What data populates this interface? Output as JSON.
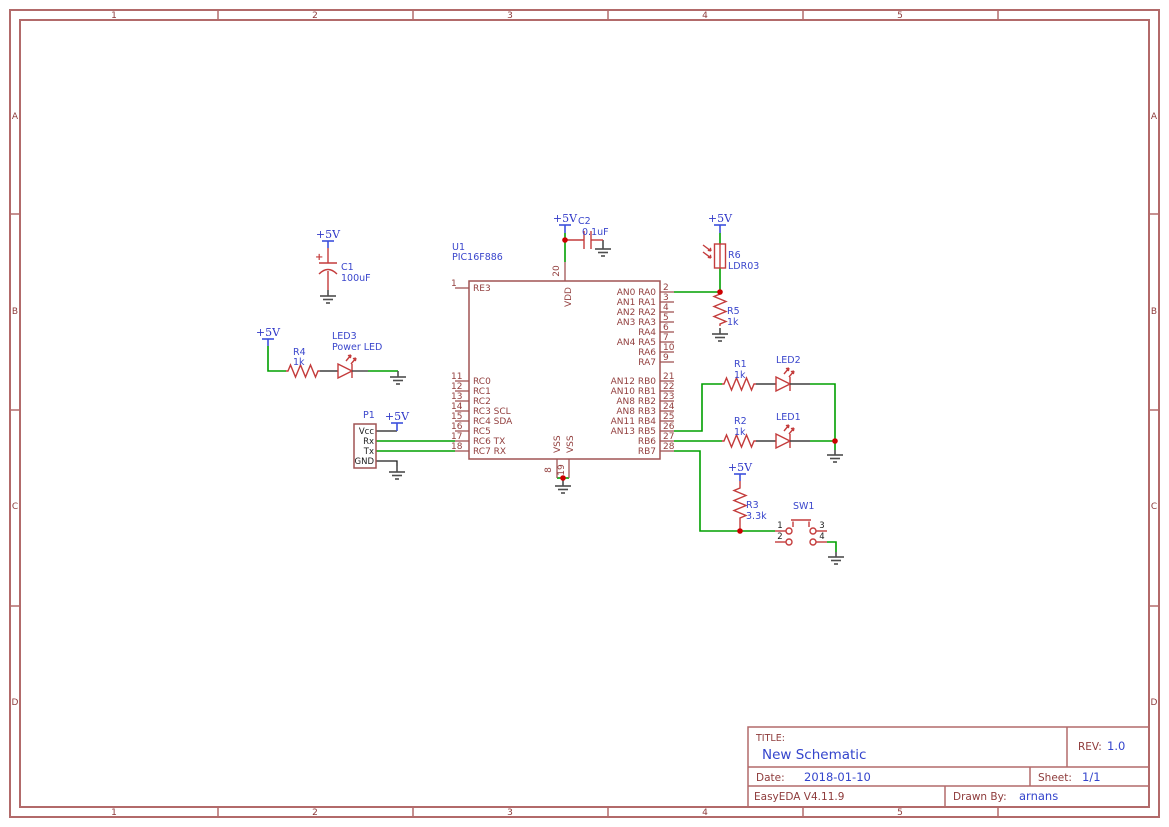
{
  "power": {
    "label": "+5V"
  },
  "sheet": {
    "frame": {
      "columns": [
        "1",
        "2",
        "3",
        "4",
        "5"
      ],
      "rows": [
        "A",
        "B",
        "C",
        "D"
      ]
    },
    "title_block": {
      "title_label": "TITLE:",
      "title": "New Schematic",
      "rev_label": "REV:",
      "rev": "1.0",
      "date_label": "Date:",
      "date": "2018-01-10",
      "sheet_label": "Sheet:",
      "sheet": "1/1",
      "tool": "EasyEDA V4.11.9",
      "drawn_by_label": "Drawn By:",
      "drawn_by": "arnans"
    }
  },
  "components": {
    "u1": {
      "designator": "U1",
      "value": "PIC16F886",
      "pins_left": [
        {
          "num": "1",
          "name": "RE3"
        },
        {
          "num": "11",
          "name": "RC0"
        },
        {
          "num": "12",
          "name": "RC1"
        },
        {
          "num": "13",
          "name": "RC2"
        },
        {
          "num": "14",
          "name": "RC3 SCL"
        },
        {
          "num": "15",
          "name": "RC4 SDA"
        },
        {
          "num": "16",
          "name": "RC5"
        },
        {
          "num": "17",
          "name": "RC6 TX"
        },
        {
          "num": "18",
          "name": "RC7 RX"
        }
      ],
      "pins_right": [
        {
          "num": "2",
          "name": "AN0 RA0"
        },
        {
          "num": "3",
          "name": "AN1 RA1"
        },
        {
          "num": "4",
          "name": "AN2 RA2"
        },
        {
          "num": "5",
          "name": "AN3 RA3"
        },
        {
          "num": "6",
          "name": "RA4"
        },
        {
          "num": "7",
          "name": "AN4 RA5"
        },
        {
          "num": "10",
          "name": "RA6"
        },
        {
          "num": "9",
          "name": "RA7"
        },
        {
          "num": "21",
          "name": "AN12 RB0"
        },
        {
          "num": "22",
          "name": "AN10 RB1"
        },
        {
          "num": "23",
          "name": "AN8 RB2"
        },
        {
          "num": "24",
          "name": "AN8 RB3"
        },
        {
          "num": "25",
          "name": "AN11 RB4"
        },
        {
          "num": "26",
          "name": "AN13 RB5"
        },
        {
          "num": "27",
          "name": "RB6"
        },
        {
          "num": "28",
          "name": "RB7"
        }
      ],
      "pin_top": {
        "num": "20",
        "name": "VDD"
      },
      "pins_bottom": [
        {
          "num": "8",
          "name": "VSS"
        },
        {
          "num": "19",
          "name": "VSS"
        }
      ]
    },
    "c1": {
      "designator": "C1",
      "value": "100uF",
      "polarity": "+"
    },
    "c2": {
      "designator": "C2",
      "value": "0.1uF"
    },
    "r1": {
      "designator": "R1",
      "value": "1k"
    },
    "r2": {
      "designator": "R2",
      "value": "1k"
    },
    "r3": {
      "designator": "R3",
      "value": "3.3k"
    },
    "r4": {
      "designator": "R4",
      "value": "1k"
    },
    "r5": {
      "designator": "R5",
      "value": "1k"
    },
    "r6": {
      "designator": "R6",
      "value": "LDR03"
    },
    "led1": {
      "designator": "LED1"
    },
    "led2": {
      "designator": "LED2"
    },
    "led3": {
      "designator": "LED3",
      "value": "Power LED"
    },
    "p1": {
      "designator": "P1",
      "pins": [
        "Vcc",
        "Rx",
        "Tx",
        "GND"
      ]
    },
    "sw1": {
      "designator": "SW1",
      "pins": [
        "1",
        "2",
        "3",
        "4"
      ]
    }
  },
  "colors": {
    "wire_green": "#00A000",
    "symbol_red": "#C43C3C",
    "ic_outline": "#A05454",
    "frame_red": "#B26A6A",
    "label_blue": "#3A46CC",
    "net_flag_blue": "#3C50DC",
    "ground_gray": "#4D4D4D",
    "junction_red": "#CC0000"
  }
}
